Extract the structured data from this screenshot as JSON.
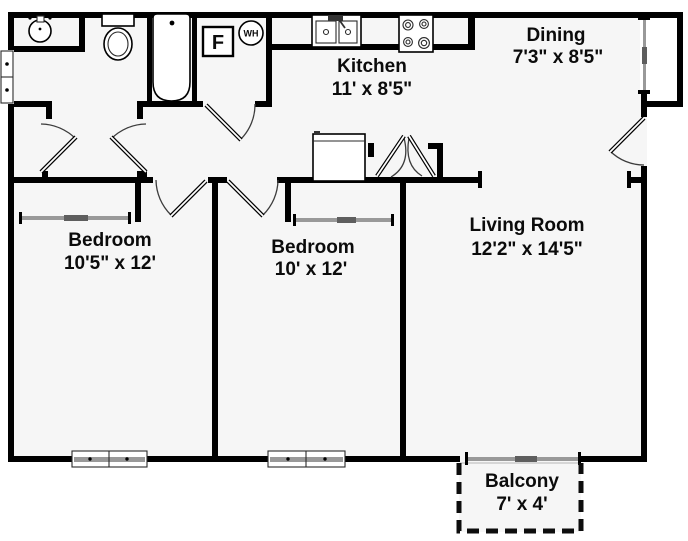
{
  "rooms": {
    "kitchen": {
      "name": "Kitchen",
      "size": "11' x 8'5\""
    },
    "dining": {
      "name": "Dining",
      "size": "7'3\" x 8'5\""
    },
    "living_room": {
      "name": "Living Room",
      "size": "12'2\" x 14'5\""
    },
    "bedroom_left": {
      "name": "Bedroom",
      "size": "10'5\" x 12'"
    },
    "bedroom_middle": {
      "name": "Bedroom",
      "size": "10' x 12'"
    },
    "balcony": {
      "name": "Balcony",
      "size": "7' x 4'"
    }
  },
  "fixtures": {
    "furnace_label": "F",
    "water_heater_label": "WH"
  },
  "colors": {
    "wall": "#000000",
    "floor": "#f6f6f6",
    "window_gray": "#999999",
    "slider_dark": "#5e5e5e"
  }
}
